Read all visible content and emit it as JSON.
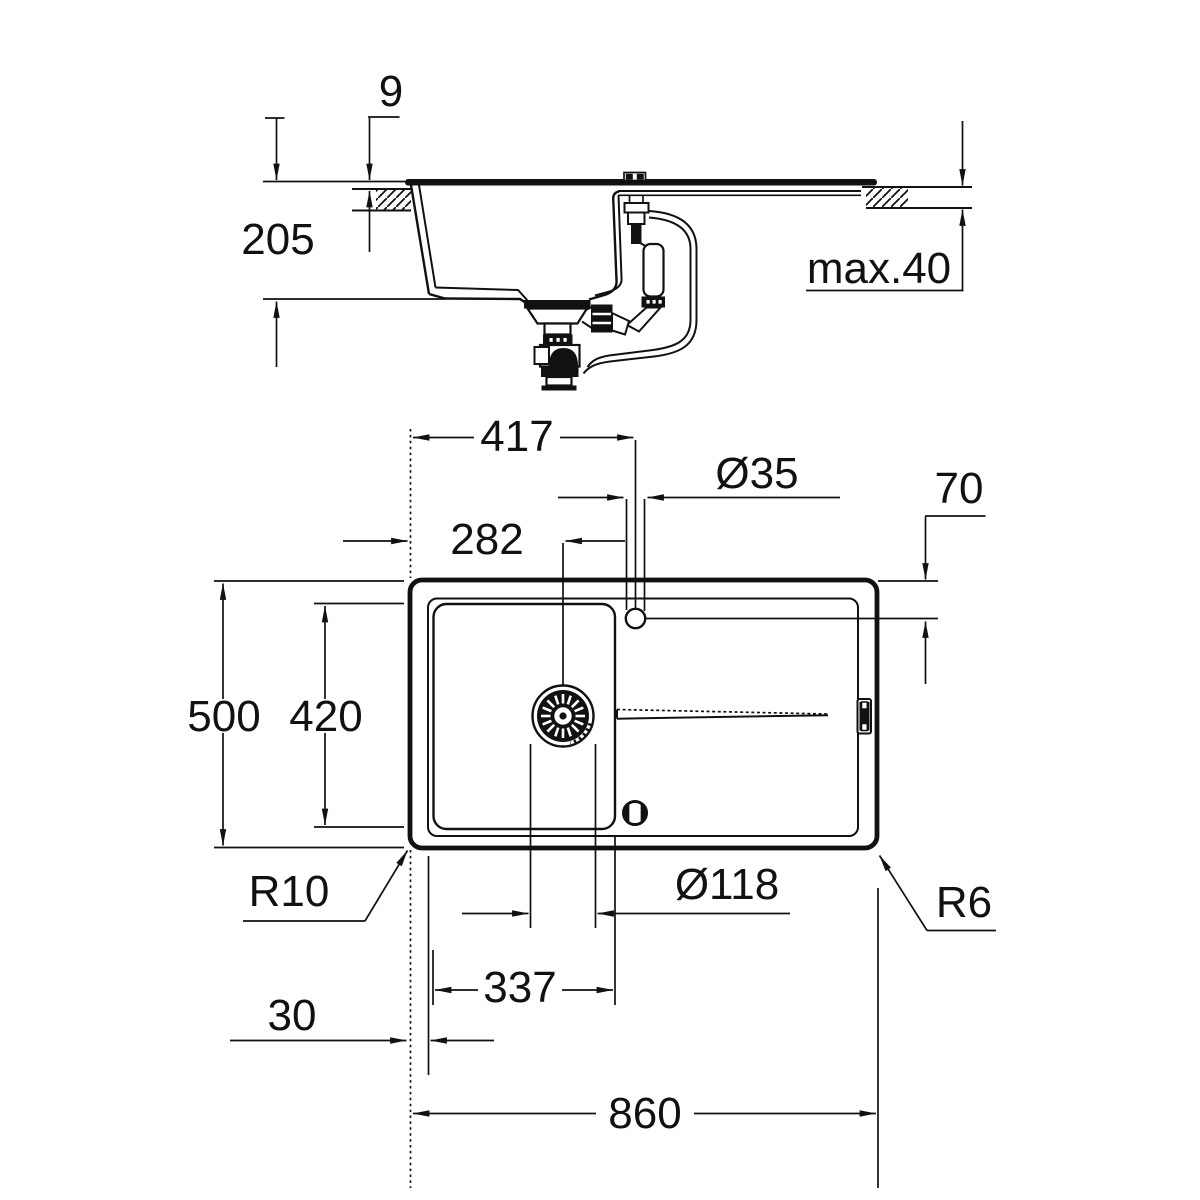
{
  "drawing": {
    "kind": "kitchen sink technical dimension drawing",
    "units": "mm",
    "line_color": "#111111",
    "background_color": "#ffffff",
    "views": [
      "side section view",
      "top plan view"
    ]
  },
  "section_view": {
    "dims": {
      "rim_thickness": {
        "label": "9"
      },
      "bowl_depth": {
        "label": "205"
      },
      "counter_thickness": {
        "label": "max.40"
      }
    }
  },
  "plan_view": {
    "dims": {
      "left_edge_to_tap_center": {
        "label": "417"
      },
      "left_edge_to_drain_center": {
        "label": "282"
      },
      "tap_hole_diameter": {
        "label": "Ø35"
      },
      "top_edge_to_tap_center": {
        "label": "70"
      },
      "overall_depth": {
        "label": "500"
      },
      "bowl_length": {
        "label": "420"
      },
      "bowl_corner_radius": {
        "label": "R10"
      },
      "drain_diameter": {
        "label": "Ø118"
      },
      "bowl_width": {
        "label": "337"
      },
      "edge_to_bowl": {
        "label": "30"
      },
      "overall_width": {
        "label": "860"
      },
      "outer_corner_radius": {
        "label": "R6"
      }
    }
  }
}
